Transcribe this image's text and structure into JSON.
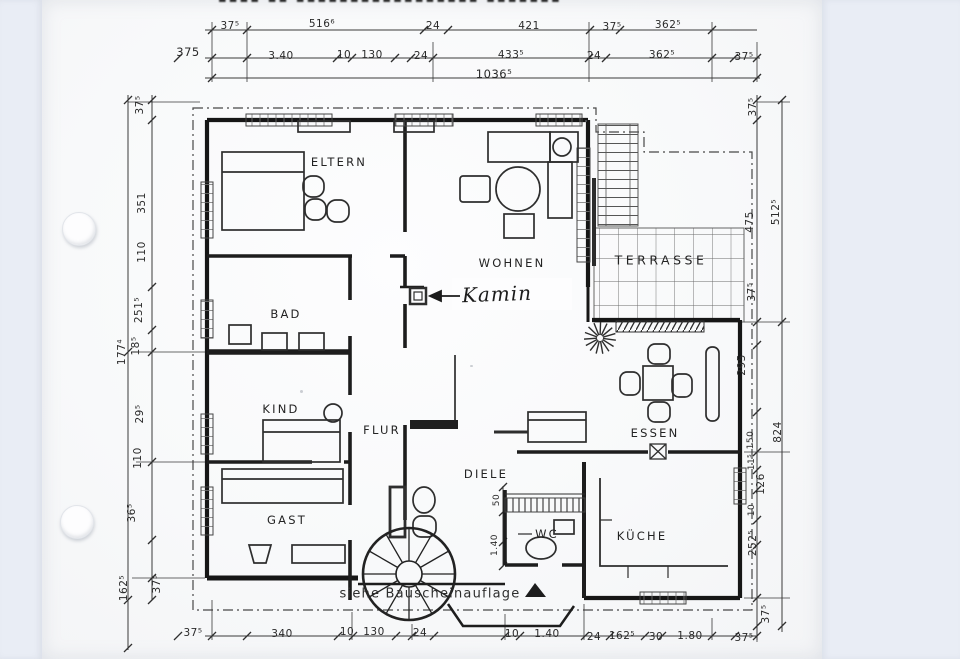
{
  "header": {
    "cropped_title": "▪▪▪▪ ▪▪ ▪▪▪▪▪▪▪▪▪▪▪▪▪▪▪▪▪ ▪▪▪▪▪▪▪"
  },
  "colors": {
    "scanner_bed": "#e9edf5",
    "paper": "#fbfcfd",
    "ink": "#1f1f1f",
    "dim_line": "#3a3a3a"
  },
  "drawing_type": "floor plan scan",
  "rooms": [
    "ELTERN",
    "WOHNEN",
    "TERRASSE",
    "BAD",
    "KIND",
    "FLUR",
    "DIELE",
    "ESSEN",
    "GAST",
    "WC",
    "KÜCHE"
  ],
  "annotations": {
    "fireplace": "Kamin",
    "note": "siehe Bauscheinauflage",
    "total_width": "1036⁵"
  },
  "labels": [
    {
      "name": "room-label-eltern",
      "text": "ELTERN",
      "x": 339,
      "y": 162,
      "cls": "room"
    },
    {
      "name": "room-label-wohnen",
      "text": "WOHNEN",
      "x": 512,
      "y": 263,
      "cls": "room"
    },
    {
      "name": "room-label-terrasse",
      "text": "TERRASSE",
      "x": 661,
      "y": 260,
      "cls": "room room-big"
    },
    {
      "name": "room-label-bad",
      "text": "BAD",
      "x": 286,
      "y": 314,
      "cls": "room"
    },
    {
      "name": "room-label-kind",
      "text": "KIND",
      "x": 281,
      "y": 409,
      "cls": "room"
    },
    {
      "name": "room-label-flur",
      "text": "FLUR",
      "x": 382,
      "y": 430,
      "cls": "room"
    },
    {
      "name": "room-label-diele",
      "text": "DIELE",
      "x": 486,
      "y": 474,
      "cls": "room"
    },
    {
      "name": "room-label-essen",
      "text": "ESSEN",
      "x": 655,
      "y": 433,
      "cls": "room"
    },
    {
      "name": "room-label-gast",
      "text": "GAST",
      "x": 287,
      "y": 520,
      "cls": "room"
    },
    {
      "name": "room-label-wc",
      "text": "WC",
      "x": 547,
      "y": 534,
      "cls": "room"
    },
    {
      "name": "room-label-kueche",
      "text": "KÜCHE",
      "x": 642,
      "y": 536,
      "cls": "room"
    },
    {
      "name": "kamin-label",
      "text": "Kamin",
      "x": 497,
      "y": 294,
      "cls": "hand"
    },
    {
      "name": "note-bauscheinauflage",
      "text": "siehe Bauscheinauflage",
      "x": 430,
      "y": 594,
      "cls": "note"
    },
    {
      "name": "dim-label",
      "text": "37⁵",
      "x": 230,
      "y": 26
    },
    {
      "name": "dim-label",
      "text": "516⁶",
      "x": 322,
      "y": 24
    },
    {
      "name": "dim-label",
      "text": "24",
      "x": 433,
      "y": 26
    },
    {
      "name": "dim-label",
      "text": "421",
      "x": 529,
      "y": 26
    },
    {
      "name": "dim-label",
      "text": "37⁵",
      "x": 612,
      "y": 27
    },
    {
      "name": "dim-label",
      "text": "362⁵",
      "x": 668,
      "y": 25
    },
    {
      "name": "dim-label",
      "text": "375",
      "x": 188,
      "y": 52,
      "cls": "big"
    },
    {
      "name": "dim-label",
      "text": "3.40",
      "x": 281,
      "y": 56
    },
    {
      "name": "dim-label",
      "text": "10",
      "x": 344,
      "y": 55
    },
    {
      "name": "dim-label",
      "text": "130",
      "x": 372,
      "y": 55
    },
    {
      "name": "dim-label",
      "text": "24",
      "x": 421,
      "y": 56
    },
    {
      "name": "dim-label",
      "text": "433⁵",
      "x": 511,
      "y": 55
    },
    {
      "name": "dim-label",
      "text": "24",
      "x": 594,
      "y": 56
    },
    {
      "name": "dim-label",
      "text": "362⁵",
      "x": 662,
      "y": 55
    },
    {
      "name": "dim-label",
      "text": "37⁵",
      "x": 744,
      "y": 57
    },
    {
      "name": "dim-label",
      "text": "1036⁵",
      "x": 494,
      "y": 74,
      "cls": "big"
    },
    {
      "name": "dim-label",
      "text": "37⁵",
      "x": 193,
      "y": 633
    },
    {
      "name": "dim-label",
      "text": "340",
      "x": 282,
      "y": 634
    },
    {
      "name": "dim-label",
      "text": "10",
      "x": 347,
      "y": 632
    },
    {
      "name": "dim-label",
      "text": "130",
      "x": 374,
      "y": 632
    },
    {
      "name": "dim-label",
      "text": "24",
      "x": 420,
      "y": 633
    },
    {
      "name": "dim-label",
      "text": "10",
      "x": 512,
      "y": 634
    },
    {
      "name": "dim-label",
      "text": "1.40",
      "x": 547,
      "y": 634
    },
    {
      "name": "dim-label",
      "text": "24",
      "x": 594,
      "y": 637
    },
    {
      "name": "dim-label",
      "text": "162⁵",
      "x": 622,
      "y": 636
    },
    {
      "name": "dim-label",
      "text": "30",
      "x": 656,
      "y": 637
    },
    {
      "name": "dim-label",
      "text": "1.80",
      "x": 690,
      "y": 636
    },
    {
      "name": "dim-label",
      "text": "37⁵",
      "x": 744,
      "y": 638
    },
    {
      "name": "dim-label",
      "text": "37⁵",
      "x": 140,
      "y": 105,
      "rot": -90
    },
    {
      "name": "dim-label",
      "text": "351",
      "x": 142,
      "y": 203,
      "rot": -90
    },
    {
      "name": "dim-label",
      "text": "110",
      "x": 142,
      "y": 252,
      "rot": -90
    },
    {
      "name": "dim-label",
      "text": "251⁵",
      "x": 139,
      "y": 310,
      "rot": -90
    },
    {
      "name": "dim-label",
      "text": "18⁵",
      "x": 136,
      "y": 346,
      "rot": -90
    },
    {
      "name": "dim-label",
      "text": "177⁴",
      "x": 122,
      "y": 352,
      "rot": -90
    },
    {
      "name": "dim-label",
      "text": "29⁵",
      "x": 140,
      "y": 414,
      "rot": -90
    },
    {
      "name": "dim-label",
      "text": "110",
      "x": 138,
      "y": 458,
      "rot": -90
    },
    {
      "name": "dim-label",
      "text": "36⁵",
      "x": 132,
      "y": 513,
      "rot": -90
    },
    {
      "name": "dim-label",
      "text": "37⁵",
      "x": 157,
      "y": 584,
      "rot": -90
    },
    {
      "name": "dim-label",
      "text": "162⁵",
      "x": 124,
      "y": 588,
      "rot": -90
    },
    {
      "name": "dim-label",
      "text": "37⁵",
      "x": 753,
      "y": 107,
      "rot": -90
    },
    {
      "name": "dim-label",
      "text": "475",
      "x": 750,
      "y": 222,
      "rot": -90
    },
    {
      "name": "dim-label",
      "text": "512⁵",
      "x": 776,
      "y": 212,
      "rot": -90
    },
    {
      "name": "dim-label",
      "text": "37⁵",
      "x": 752,
      "y": 292,
      "rot": -90
    },
    {
      "name": "dim-label",
      "text": "295",
      "x": 742,
      "y": 365,
      "rot": -90
    },
    {
      "name": "dim-label",
      "text": "824",
      "x": 778,
      "y": 432,
      "rot": -90
    },
    {
      "name": "dim-label",
      "text": "150",
      "x": 751,
      "y": 440,
      "rot": -90,
      "cls": "small"
    },
    {
      "name": "dim-label",
      "text": "11⁵",
      "x": 752,
      "y": 462,
      "rot": -90,
      "cls": "small"
    },
    {
      "name": "dim-label",
      "text": "126",
      "x": 761,
      "y": 484,
      "rot": -90
    },
    {
      "name": "dim-label",
      "text": "10",
      "x": 752,
      "y": 510,
      "rot": -90,
      "cls": "small"
    },
    {
      "name": "dim-label",
      "text": "252⁵",
      "x": 753,
      "y": 543,
      "rot": -90
    },
    {
      "name": "dim-label",
      "text": "37⁵",
      "x": 766,
      "y": 614,
      "rot": -90
    },
    {
      "name": "dim-label",
      "text": "50",
      "x": 497,
      "y": 500,
      "rot": -90,
      "cls": "small"
    },
    {
      "name": "dim-label",
      "text": "1.40",
      "x": 495,
      "y": 545,
      "rot": -90,
      "cls": "small"
    }
  ]
}
